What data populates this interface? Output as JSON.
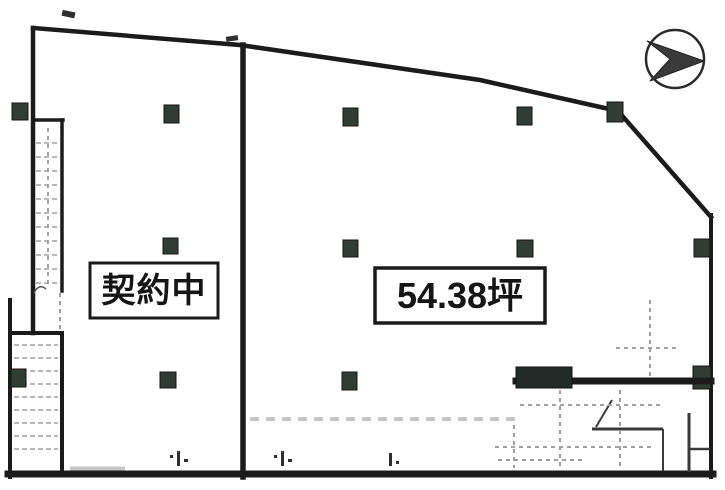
{
  "scan": {
    "background_color": "#ffffff",
    "ink_color": "#1b1b1b",
    "column_fill_color": "#323c36",
    "faint_line_color": "#a0a0a0"
  },
  "floor_plan": {
    "left_unit": {
      "label": "契約中"
    },
    "right_unit": {
      "label": "54.38坪"
    },
    "icons": {
      "north_arrow": "north-arrow"
    }
  }
}
